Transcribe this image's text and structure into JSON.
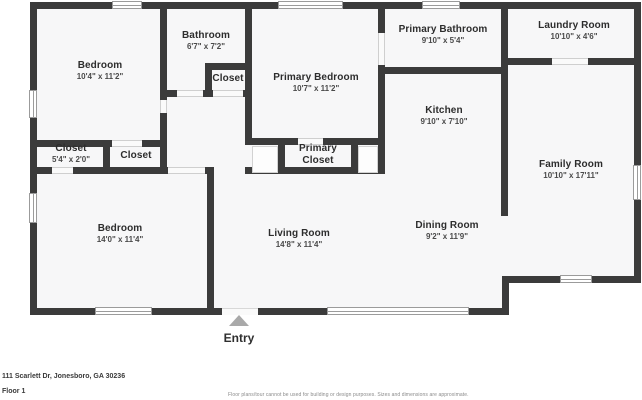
{
  "rooms": [
    {
      "name": "Bedroom",
      "dims": "10'4\" x 11'2\""
    },
    {
      "name": "Bathroom",
      "dims": "6'7\" x 7'2\""
    },
    {
      "name": "Closet",
      "dims": ""
    },
    {
      "name": "Primary Bedroom",
      "dims": "10'7\" x 11'2\""
    },
    {
      "name": "Primary Bathroom",
      "dims": "9'10\" x 5'4\""
    },
    {
      "name": "Laundry Room",
      "dims": "10'10\" x 4'6\""
    },
    {
      "name": "Kitchen",
      "dims": "9'10\" x 7'10\""
    },
    {
      "name": "Family Room",
      "dims": "10'10\" x 17'11\""
    },
    {
      "name": "Closet",
      "dims": "5'4\" x 2'0\""
    },
    {
      "name": "Closet",
      "dims": ""
    },
    {
      "name": "Primary Closet",
      "dims": ""
    },
    {
      "name": "Bedroom",
      "dims": "14'0\" x 11'4\""
    },
    {
      "name": "Living Room",
      "dims": "14'8\" x 11'4\""
    },
    {
      "name": "Dining Room",
      "dims": "9'2\" x 11'9\""
    }
  ],
  "entry": {
    "label": "Entry"
  },
  "footer": {
    "address": "111 Scarlett Dr, Jonesboro, GA 30236",
    "floor": "Floor 1",
    "disclaimer": "Floor plans/tour cannot be used for building or design purposes. Sizes and dimensions are approximate."
  },
  "colors": {
    "wall": "#3b3b3b",
    "room_fill": "#f7f7f8",
    "entry_marker": "#a9a9a9"
  }
}
